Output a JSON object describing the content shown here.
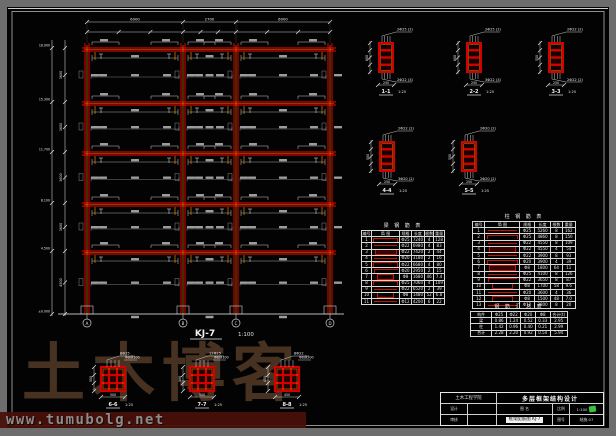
{
  "colors": {
    "red": "#d40000",
    "deep_red": "#8b0000",
    "orange": "#ff9900",
    "dim_line": "#c9c9c9",
    "dim_text": "#e8e8e8",
    "table_line": "#d9d9d9",
    "green_stamp": "#35c23a",
    "watermark": "#4a3424",
    "strip_bg": "#471009",
    "strip_text": "#949494"
  },
  "frame": {
    "name": "KJ-7",
    "scale": "1:100",
    "axes": [
      "A",
      "B",
      "C",
      "D"
    ],
    "bay_widths": [
      "6000",
      "2700",
      "6000"
    ],
    "story_heights": [
      "3600",
      "3600",
      "3600",
      "3600",
      "4500"
    ],
    "level_marks": [
      "18.900",
      "15.300",
      "11.700",
      "8.100",
      "4.500",
      "±0.000"
    ]
  },
  "sections": [
    {
      "label": "1-1",
      "scale": "1:25",
      "top": "2Φ25 (2)",
      "bottom": "2Φ22 (3)",
      "w": "250",
      "h": "600"
    },
    {
      "label": "2-2",
      "scale": "1:25",
      "top": "2Φ25 (2)",
      "bottom": "3Φ22 (3)",
      "w": "250",
      "h": "600"
    },
    {
      "label": "3-3",
      "scale": "1:25",
      "top": "2Φ22 (2)",
      "bottom": "2Φ22 (2)",
      "w": "250",
      "h": "550"
    },
    {
      "label": "4-4",
      "scale": "1:25",
      "top": "2Φ22 (2)",
      "bottom": "3Φ20 (2)",
      "w": "250",
      "h": "500"
    },
    {
      "label": "5-5",
      "scale": "1:25",
      "top": "2Φ20 (2)",
      "bottom": "2Φ20 (2)",
      "w": "250",
      "h": "500"
    }
  ],
  "col_details": [
    {
      "label": "6-6",
      "scale": "1:25",
      "main": "8Φ25",
      "tie": "Φ8@100",
      "size": "500"
    },
    {
      "label": "7-7",
      "scale": "1:25",
      "main": "12Φ25",
      "tie": "Φ8@100",
      "size": "500"
    },
    {
      "label": "8-8",
      "scale": "1:25",
      "main": "8Φ22",
      "tie": "Φ8@200",
      "size": "450"
    }
  ],
  "tables": {
    "beam": {
      "title": "梁 钢 筋 表",
      "headers": [
        "编号",
        "简  图",
        "规格",
        "长度",
        "根数",
        "重量"
      ],
      "rows": [
        [
          "1",
          "hookbar",
          "Φ25",
          "7240",
          "4",
          "128"
        ],
        [
          "2",
          "bar",
          "Φ22",
          "6980",
          "4",
          "83"
        ],
        [
          "3",
          "frame",
          "Φ22",
          "7420",
          "2",
          "44"
        ],
        [
          "4",
          "bar",
          "Φ20",
          "3180",
          "2",
          "16"
        ],
        [
          "5",
          "hookbar",
          "Φ22",
          "6680",
          "4",
          "80"
        ],
        [
          "6",
          "lhook",
          "Φ20",
          "2950",
          "2",
          "15"
        ],
        [
          "7",
          "stirrup",
          "Φ8",
          "1680",
          "46",
          "7.4"
        ],
        [
          "8",
          "hookbar",
          "Φ25",
          "7060",
          "4",
          "109"
        ],
        [
          "9",
          "bar",
          "Φ22",
          "6520",
          "2",
          "39"
        ],
        [
          "10",
          "stirrup",
          "Φ8",
          "1480",
          "52",
          "6.8"
        ],
        [
          "11",
          "bar",
          "Φ12",
          "4200",
          "6",
          "22"
        ]
      ]
    },
    "col": {
      "title": "柱 钢 筋 表",
      "headers": [
        "编号",
        "简  图",
        "规格",
        "长度",
        "根数",
        "重量"
      ],
      "rows": [
        [
          "1",
          "bar",
          "Φ25",
          "5260",
          "8",
          "162"
        ],
        [
          "2",
          "hookbar",
          "Φ25",
          "4860",
          "8",
          "150"
        ],
        [
          "3",
          "bar",
          "Φ22",
          "4550",
          "8",
          "109"
        ],
        [
          "4",
          "frame",
          "Φ22",
          "4550",
          "4",
          "54"
        ],
        [
          "5",
          "bar",
          "Φ22",
          "3900",
          "8",
          "93"
        ],
        [
          "6",
          "hookbar",
          "Φ20",
          "3900",
          "4",
          "39"
        ],
        [
          "7",
          "frame",
          "Φ8",
          "1800",
          "64",
          "11"
        ],
        [
          "8",
          "bar",
          "Φ25",
          "4100",
          "8",
          "126"
        ],
        [
          "9",
          "lhook",
          "Φ22",
          "3650",
          "8",
          "87"
        ],
        [
          "10",
          "stirrup",
          "Φ8",
          "1700",
          "58",
          "9.6"
        ],
        [
          "11",
          "bar",
          "Φ20",
          "3600",
          "4",
          "36"
        ],
        [
          "12",
          "stirrup",
          "Φ8",
          "1500",
          "48",
          "7.0"
        ],
        [
          "13",
          "bar",
          "Φ12",
          "2800",
          "8",
          "20"
        ]
      ]
    },
    "summary": {
      "title": "钢 筋 汇 总 表",
      "headers": [
        "构件",
        "Φ25",
        "Φ22",
        "Φ20",
        "Φ8",
        "合计(t)"
      ],
      "rows": [
        [
          "梁",
          "0.86",
          "1.24",
          "0.52",
          "0.33",
          "2.95"
        ],
        [
          "柱",
          "1.42",
          "0.96",
          "0.40",
          "0.21",
          "2.99"
        ],
        [
          "合计",
          "2.28",
          "2.20",
          "0.92",
          "0.54",
          "5.94"
        ]
      ]
    }
  },
  "titleblock": {
    "org": "土木工程学院",
    "project": "多层框架结构设计",
    "design_label": "设计",
    "designer": "",
    "check_label": "审核",
    "checker": "",
    "name_label": "图 名",
    "scale_label": "比例",
    "scale_value": "1:100",
    "no_label": "图号",
    "no_value": "结施-07",
    "sheet_chip": "框架配筋图 KJ-7"
  },
  "watermark": {
    "brand": "土木博客",
    "url": "www.tumubolg.net"
  }
}
